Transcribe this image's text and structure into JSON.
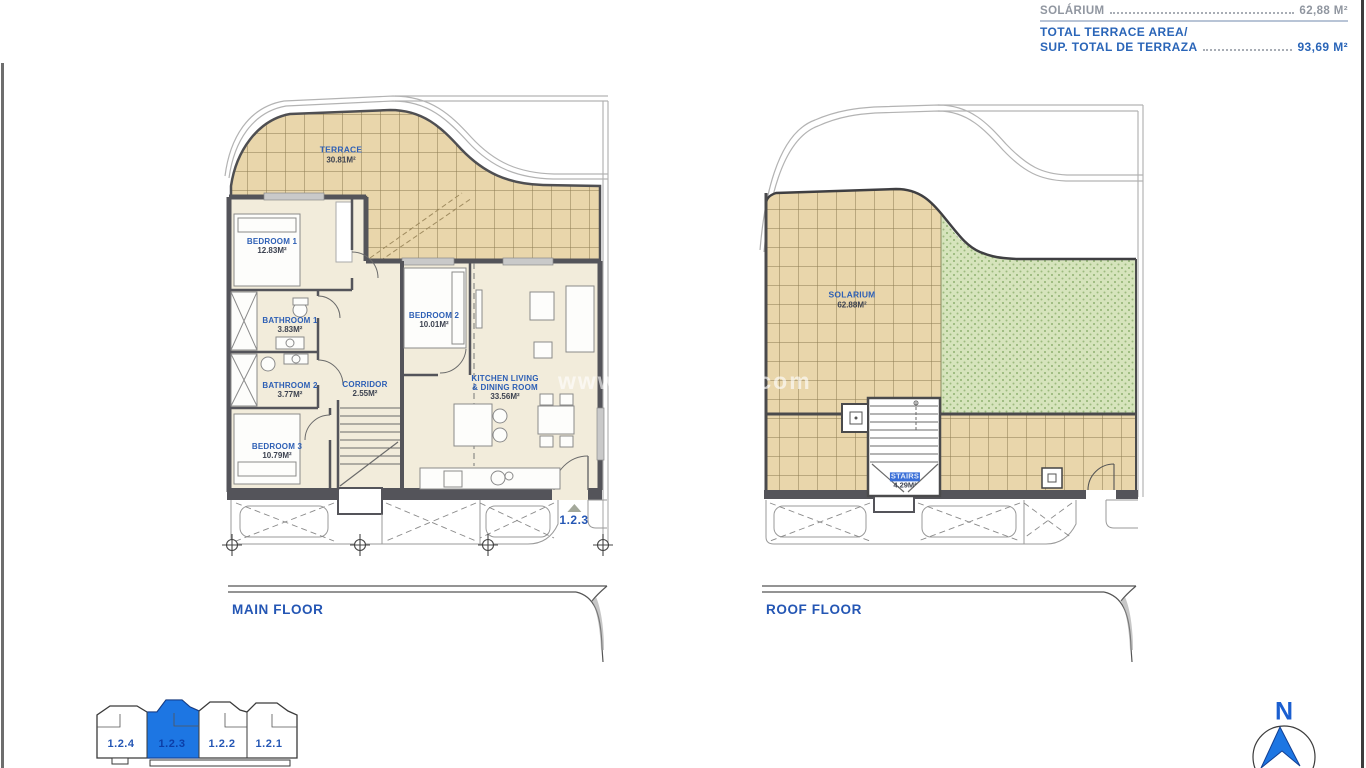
{
  "summary": {
    "partial_row_label": "SOLÁRIUM",
    "solarium_label": "SOLÁRIUM",
    "solarium_value": "62,88 M²",
    "total_label_line1": "TOTAL TERRACE AREA/",
    "total_label_line2": "SUP. TOTAL DE TERRAZA",
    "total_value": "93,69 M²"
  },
  "floors": {
    "main": {
      "title": "MAIN FLOOR",
      "unit_marker": "1.2.3",
      "rooms": {
        "terrace": {
          "name": "TERRACE",
          "area": "30.81M²"
        },
        "bedroom1": {
          "name": "BEDROOM 1",
          "area": "12.83M²"
        },
        "bathroom1": {
          "name": "BATHROOM 1",
          "area": "3.83M²"
        },
        "bathroom2": {
          "name": "BATHROOM 2",
          "area": "3.77M²"
        },
        "bedroom2": {
          "name": "BEDROOM 2",
          "area": "10.01M²"
        },
        "corridor": {
          "name": "CORRIDOR",
          "area": "2.55M²"
        },
        "kitchen": {
          "name": "KITCHEN LIVING & DINING ROOM",
          "area": "33.56M²"
        },
        "bedroom3": {
          "name": "BEDROOM 3",
          "area": "10.79M²"
        }
      }
    },
    "roof": {
      "title": "ROOF FLOOR",
      "rooms": {
        "solarium": {
          "name": "SOLARIUM",
          "area": "62.88M²"
        },
        "stairs": {
          "name": "STAIRS",
          "area": "4.29M²"
        }
      }
    }
  },
  "key_plan": {
    "units": [
      "1.2.4",
      "1.2.3",
      "1.2.2",
      "1.2.1"
    ],
    "selected_unit": "1.2.3",
    "highlight_color": "#1d76e3"
  },
  "compass": {
    "north_label": "N"
  },
  "watermark": {
    "left_fragment": "www.v",
    "right_fragment": ".com"
  },
  "colors": {
    "accent_blue": "#2456b4",
    "muted_gray": "#9aa0a8",
    "terrace_tile": "#e9d6ab",
    "solarium_green": "#d6e4bc",
    "interior_cream": "#f2ecdb",
    "wall": "#54545a"
  }
}
